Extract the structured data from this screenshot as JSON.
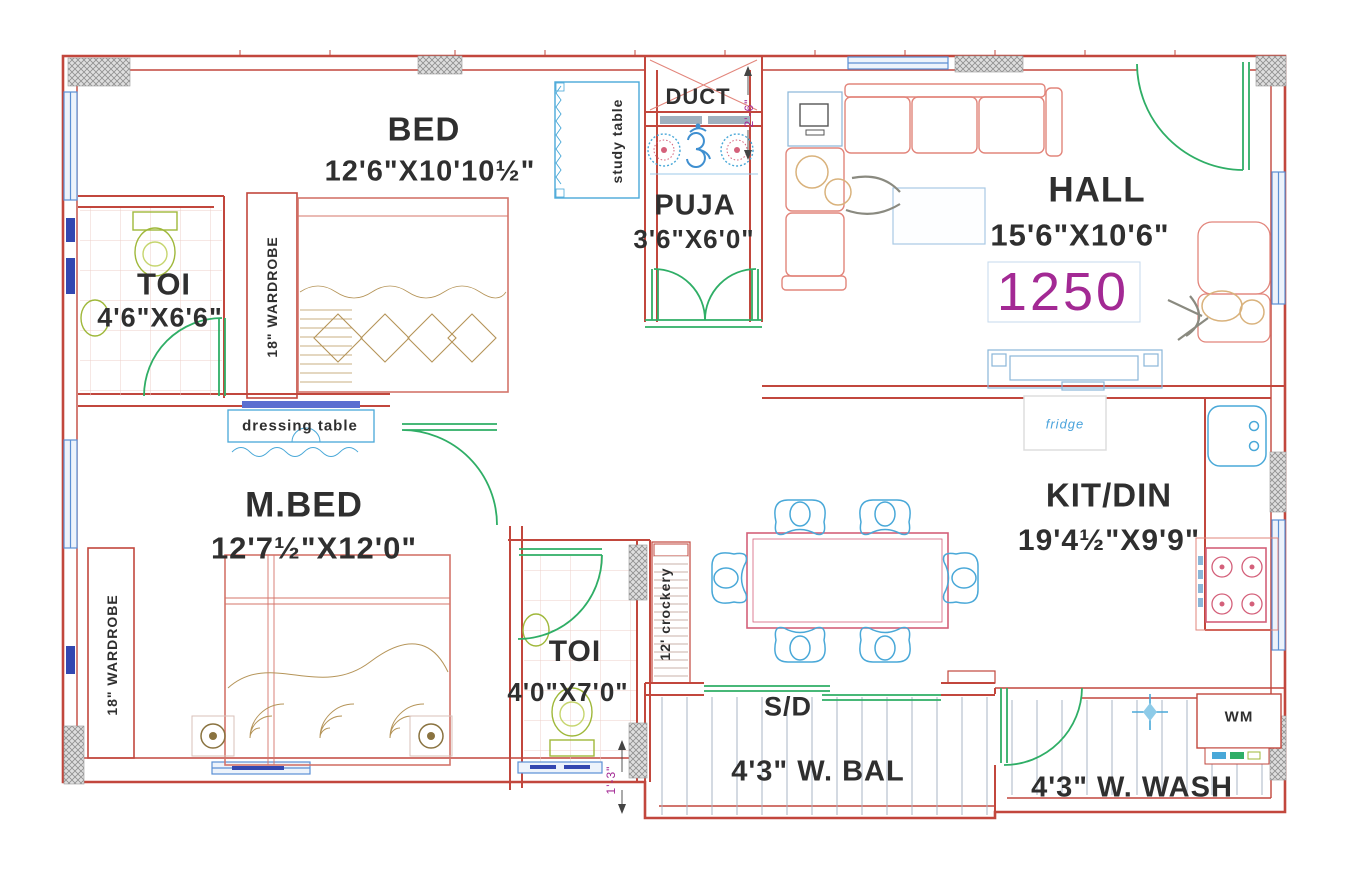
{
  "plan": {
    "area_value": "1250",
    "rooms": [
      {
        "name": "BED",
        "dims": "12'6\"X10'10½\""
      },
      {
        "name": "TOI",
        "dims": "4'6\"X6'6\""
      },
      {
        "name": "PUJA",
        "dims": "3'6\"X6'0\""
      },
      {
        "name": "DUCT",
        "dims": ""
      },
      {
        "name": "HALL",
        "dims": "15'6\"X10'6\""
      },
      {
        "name": "M.BED",
        "dims": "12'7½\"X12'0\""
      },
      {
        "name": "TOI",
        "dims": "4'0\"X7'0\""
      },
      {
        "name": "KIT/DIN",
        "dims": "19'4½\"X9'9\""
      },
      {
        "name": "4'3\" W. BAL",
        "dims": ""
      },
      {
        "name": "4'3\" W. WASH",
        "dims": ""
      }
    ],
    "labels": {
      "wardrobe_top": "18\" WARDROBE",
      "wardrobe_bottom": "18\" WARDROBE",
      "study_table": "study table",
      "dressing_table": "dressing table",
      "crockery": "12' crockery",
      "sliding_door": "S/D",
      "washing_machine": "WM",
      "fridge": "fridge",
      "om_symbol": "ॐ"
    },
    "dimension_marks": {
      "duct_width": "2'-6\"",
      "balcony_offset": "1'-3\""
    },
    "colors": {
      "wall": "#c2473d",
      "furniture": "#e2857b",
      "accent_pink": "#d4607a",
      "window_blue": "#5b8fd4",
      "fixture_blue": "#49a8d8",
      "door_green": "#2fae66",
      "fixture_olive": "#9fb83a",
      "tan": "#b59458",
      "area_magenta": "#a32994",
      "text": "#2f2f2f"
    }
  }
}
